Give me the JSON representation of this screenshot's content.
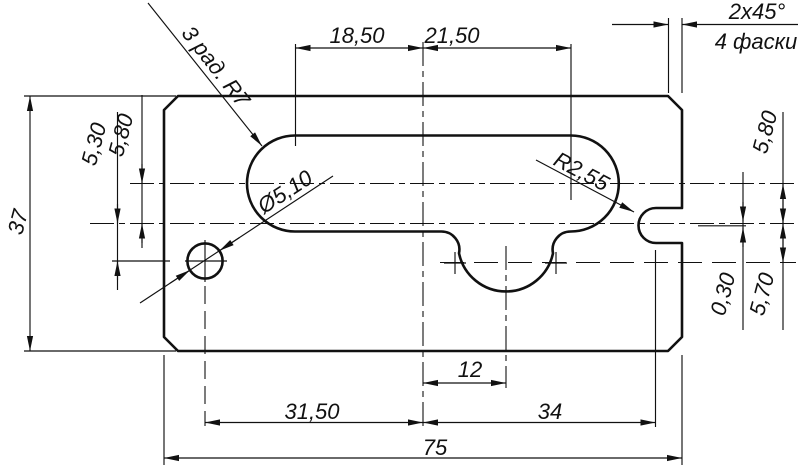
{
  "drawing": {
    "top_dimensions": {
      "center_to_slot_left": "18,50",
      "center_to_slot_right": "21,50"
    },
    "chamfer": {
      "size": "2x45°",
      "note": "4 фаски"
    },
    "notes": {
      "slot_radii": "3 рад. R7",
      "hole_diameter": "Ø5,10",
      "notch_radius": "R2,55"
    },
    "left_dimensions": {
      "overall_height": "37",
      "center_to_hole": "5,30",
      "slot_axis_to_center": "5,80"
    },
    "right_dimensions": {
      "slot_axis_to_center": "5,80",
      "axis_offset": "0,30",
      "center_to_arc_axis": "5,70"
    },
    "bottom_dimensions": {
      "center_to_arc_center": "12",
      "hole_to_center": "31,50",
      "center_to_notch": "34",
      "overall_width": "75"
    },
    "colors": {
      "line": "#111111",
      "background": "#ffffff"
    }
  }
}
